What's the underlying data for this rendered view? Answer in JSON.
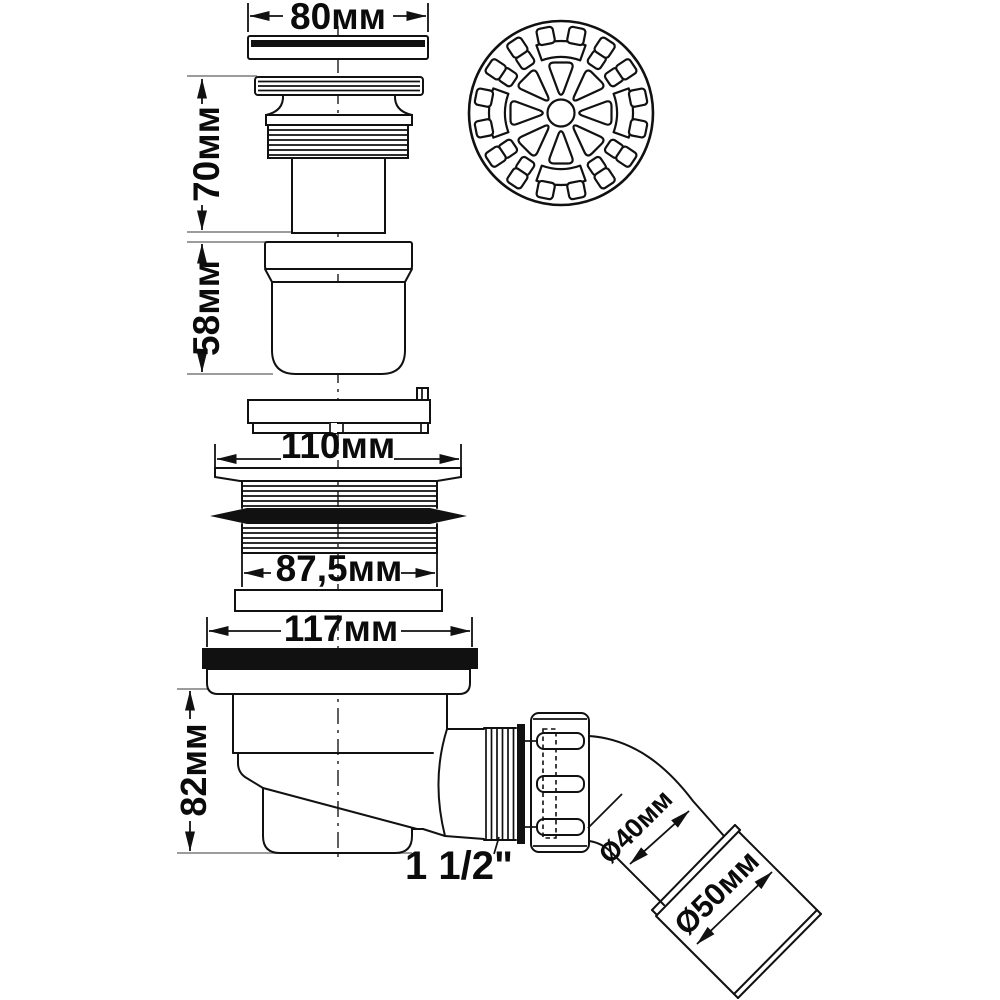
{
  "dims": {
    "cap_width": "80мм",
    "core_height": "70мм",
    "cup_height": "58мм",
    "flange_width": "110мм",
    "thread_width": "87,5мм",
    "body_width": "117мм",
    "body_height": "82мм",
    "outlet_thread": "1 1/2\"",
    "pipe_diameter": "Ø40мм",
    "sleeve_diameter": "Ø50мм"
  },
  "colors": {
    "line": "#111111",
    "extension_line": "#9c9c9c",
    "seal_fill": "#000000",
    "background": "#ffffff"
  }
}
